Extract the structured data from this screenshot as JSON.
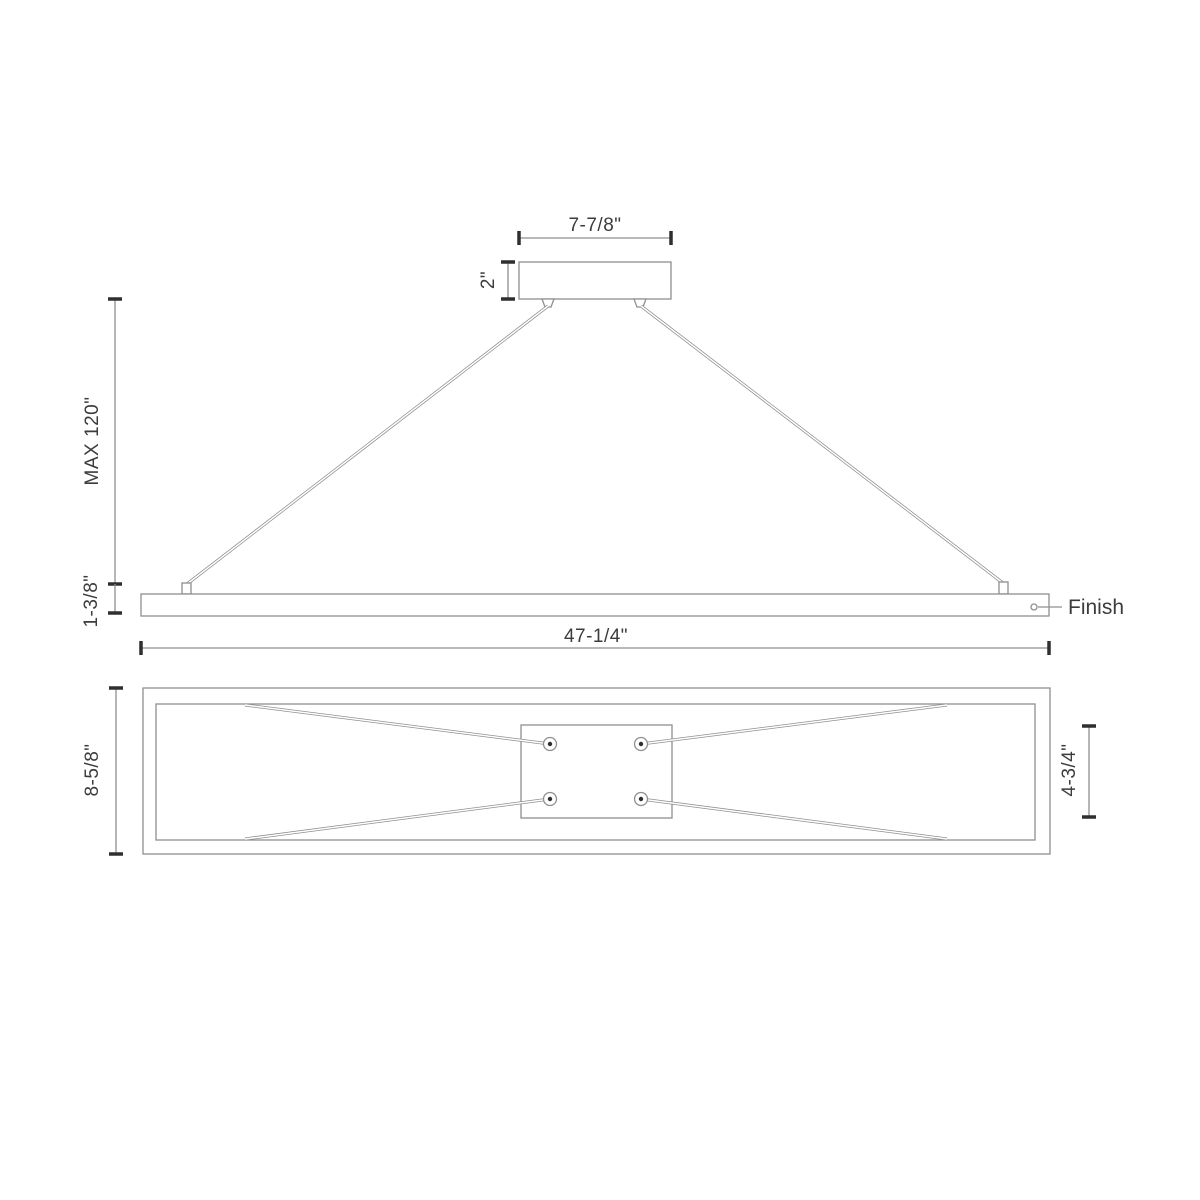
{
  "colors": {
    "line": "#8f8f8f",
    "dark": "#2f2f2f",
    "text": "#3c3c3c",
    "background": "#ffffff"
  },
  "drawing": {
    "type": "linear-pendant-fixture-dimension-drawing"
  },
  "elevation": {
    "dims": {
      "canopy_width": "7-7/8\"",
      "canopy_height": "2\"",
      "max_suspension": "MAX 120\"",
      "bar_height": "1-3/8\"",
      "bar_length": "47-1/4\""
    },
    "finish_label": "Finish"
  },
  "plan": {
    "dims": {
      "body_depth": "8-5/8\"",
      "plate_depth": "4-3/4\""
    }
  }
}
